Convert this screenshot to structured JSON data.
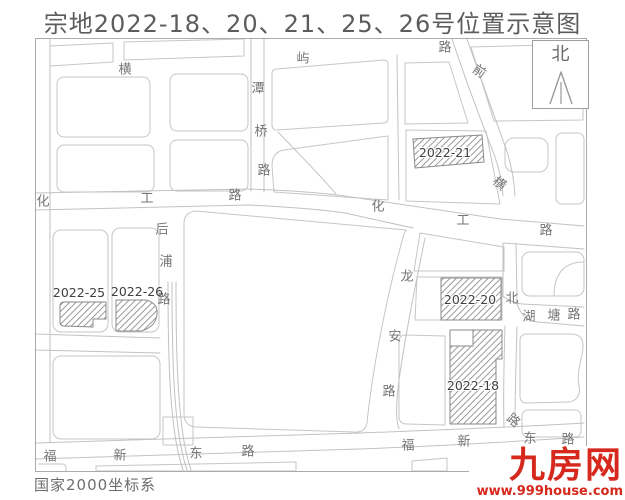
{
  "title": "宗地2022-18、20、21、25、26号位置示意图",
  "map": {
    "coordinate_system": "国家2000坐标系",
    "north_label": "北",
    "road_labels": [
      {
        "char": "横",
        "x": 125,
        "y": 70,
        "rot": 0
      },
      {
        "char": "屿",
        "x": 303,
        "y": 59,
        "rot": 0
      },
      {
        "char": "路",
        "x": 445,
        "y": 48,
        "rot": 0
      },
      {
        "char": "前",
        "x": 479,
        "y": 72,
        "rot": 35
      },
      {
        "char": "潭",
        "x": 258,
        "y": 89,
        "rot": 0
      },
      {
        "char": "桥",
        "x": 261,
        "y": 132,
        "rot": 0
      },
      {
        "char": "路",
        "x": 264,
        "y": 171,
        "rot": 0
      },
      {
        "char": "化",
        "x": 43,
        "y": 202,
        "rot": 0
      },
      {
        "char": "工",
        "x": 147,
        "y": 199,
        "rot": 0
      },
      {
        "char": "路",
        "x": 235,
        "y": 196,
        "rot": 0
      },
      {
        "char": "化",
        "x": 378,
        "y": 207,
        "rot": 0
      },
      {
        "char": "工",
        "x": 463,
        "y": 221,
        "rot": 0
      },
      {
        "char": "路",
        "x": 546,
        "y": 231,
        "rot": 0
      },
      {
        "char": "横",
        "x": 499,
        "y": 184,
        "rot": 38
      },
      {
        "char": "后",
        "x": 162,
        "y": 230,
        "rot": 0
      },
      {
        "char": "浦",
        "x": 166,
        "y": 262,
        "rot": 0
      },
      {
        "char": "路",
        "x": 164,
        "y": 300,
        "rot": 0
      },
      {
        "char": "龙",
        "x": 407,
        "y": 277,
        "rot": 0
      },
      {
        "char": "安",
        "x": 395,
        "y": 337,
        "rot": 0
      },
      {
        "char": "路",
        "x": 389,
        "y": 392,
        "rot": 0
      },
      {
        "char": "北",
        "x": 512,
        "y": 299,
        "rot": 0
      },
      {
        "char": "湖",
        "x": 529,
        "y": 317,
        "rot": 0
      },
      {
        "char": "塘",
        "x": 554,
        "y": 316,
        "rot": 0
      },
      {
        "char": "路",
        "x": 574,
        "y": 315,
        "rot": 0
      },
      {
        "char": "路",
        "x": 513,
        "y": 421,
        "rot": 40
      },
      {
        "char": "福",
        "x": 50,
        "y": 457,
        "rot": 0
      },
      {
        "char": "新",
        "x": 120,
        "y": 456,
        "rot": 0
      },
      {
        "char": "东",
        "x": 196,
        "y": 454,
        "rot": 0
      },
      {
        "char": "路",
        "x": 248,
        "y": 452,
        "rot": 0
      },
      {
        "char": "福",
        "x": 408,
        "y": 446,
        "rot": 0
      },
      {
        "char": "新",
        "x": 464,
        "y": 442,
        "rot": 0
      },
      {
        "char": "东",
        "x": 530,
        "y": 439,
        "rot": 0
      },
      {
        "char": "路",
        "x": 568,
        "y": 440,
        "rot": 0
      }
    ],
    "parcels": [
      {
        "label": "2022-21",
        "x": 445,
        "y": 153,
        "on_hatch": true
      },
      {
        "label": "2022-25",
        "x": 79,
        "y": 293,
        "on_hatch": false
      },
      {
        "label": "2022-26",
        "x": 137,
        "y": 292,
        "on_hatch": false
      },
      {
        "label": "2022-20",
        "x": 470,
        "y": 300,
        "on_hatch": true
      },
      {
        "label": "2022-18",
        "x": 473,
        "y": 386,
        "on_hatch": true
      }
    ]
  },
  "watermark": {
    "name": "九房网",
    "url": "www.999house.com"
  },
  "colors": {
    "accent_red": "#d6281c",
    "map_line": "#c6c6c6",
    "parcel_line": "#8a8a8a",
    "title_text": "#5c5c5c",
    "road_text": "#757575"
  }
}
